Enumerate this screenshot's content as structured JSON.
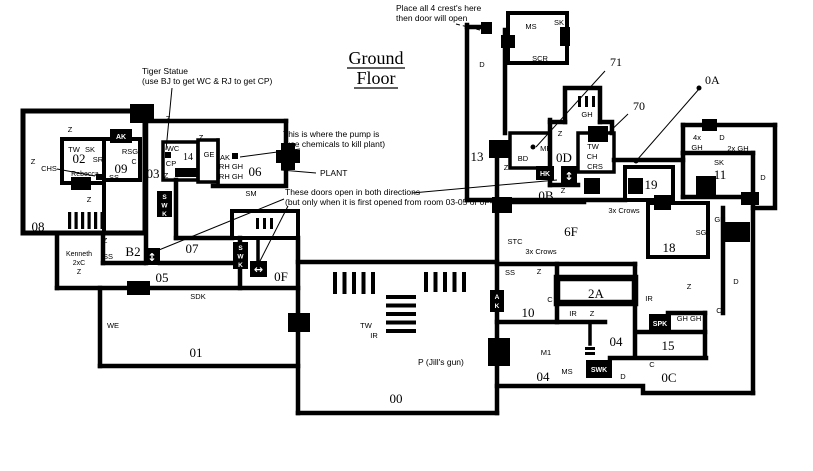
{
  "title": {
    "line1": "Ground",
    "line2": "Floor"
  },
  "annotations": {
    "crest_line1": "Place all 4 crest's here",
    "crest_line2": "then door will open",
    "tiger_line1": "Tiger Statue",
    "tiger_line2": "(use BJ to get WC & RJ to get CP)",
    "pump_line1": "This is where the pump is",
    "pump_line2": "(use chemicals to kill plant)",
    "plant_label": "PLANT",
    "doors_line1": "These doors open in both directions",
    "doors_line2": "(but only when it is first opened from room 03-05 or 0F-05)",
    "ref_71": "71",
    "ref_70": "70",
    "ref_0a": "0A"
  },
  "rooms": {
    "r00": "00",
    "r01": "01",
    "r02": "02",
    "r03": "03",
    "r04_upper": "04",
    "r04_lower": "04",
    "r05": "05",
    "r06": "06",
    "r07": "07",
    "r08": "08",
    "r09": "09",
    "r10": "10",
    "r11": "11",
    "r13": "13",
    "r14": "14",
    "r15": "15",
    "r18": "18",
    "r19": "19",
    "r0b": "0B",
    "r0c": "0C",
    "r0d": "0D",
    "r0f": "0F",
    "r2a": "2A",
    "r6f": "6F",
    "rb2": "B2",
    "rm1": "M1"
  },
  "codes": {
    "tw": "TW",
    "sk": "SK",
    "sr": "SR",
    "chs": "CHS",
    "rsg": "RSG",
    "c": "C",
    "ss": "SS",
    "z": "Z",
    "ak": "AK",
    "wc": "WC",
    "cp": "CP",
    "ge": "GE",
    "rh_gh": "RH GH",
    "sm": "SM",
    "sdk": "SDK",
    "we": "WE",
    "ir": "IR",
    "ms": "MS",
    "scr": "SCR",
    "bd": "BD",
    "mr": "MR",
    "gh": "GH",
    "ch": "CH",
    "crs": "CRS",
    "stc": "STC",
    "sg": "SG",
    "d": "D",
    "gh_gh": "GH GH",
    "x2_gh": "2x GH",
    "x4": "4x",
    "x3_crows": "3x Crows",
    "x2c": "2xC"
  },
  "people": {
    "rebecca": "Rebecca",
    "kenneth": "Kenneth"
  },
  "items": {
    "p_jills_gun": "P (Jill's gun)"
  },
  "badges": {
    "ak": "AK",
    "hk": "HK",
    "spk": "SPK",
    "swk": "SWK",
    "s": "S",
    "w": "W",
    "k": "K",
    "a": "A",
    "updown": "↕",
    "leftright": "↔"
  }
}
